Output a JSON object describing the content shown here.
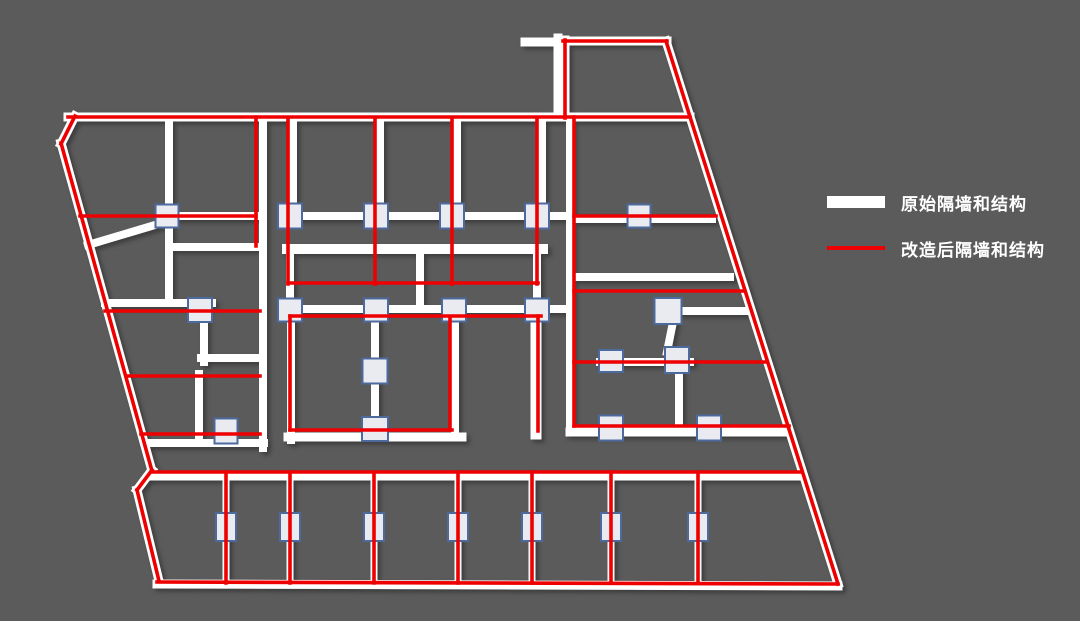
{
  "page": {
    "background_color": "#5b5b5b",
    "description": "Floor plan diagram showing original walls (thick white) overlaid with renovated partition walls and structure (red lines), with square structural columns"
  },
  "legend": {
    "items": [
      {
        "id": "original",
        "label": "原始隔墙和结构",
        "swatch_color": "#ffffff",
        "swatch_height": 12
      },
      {
        "id": "renovated",
        "label": "改造后隔墙和结构",
        "swatch_color": "#ee0000",
        "swatch_height": 4
      }
    ]
  },
  "floorplan": {
    "canvas": {
      "width": 1080,
      "height": 621
    },
    "colors": {
      "wall_white": "#ffffff",
      "wall_red": "#ee0000",
      "column_fill": "#e9ebf0",
      "column_border": "#4d6a9f"
    },
    "stroke": {
      "white_width": 8,
      "red_width": 3.6,
      "column_border_width": 2
    },
    "white_walls": [
      [
        68,
        117,
        690,
        117,
        9
      ],
      [
        75,
        116,
        61,
        144,
        9
      ],
      [
        61,
        143,
        152,
        471,
        9
      ],
      [
        152,
        470,
        137,
        490,
        9
      ],
      [
        137,
        490,
        159,
        581,
        9
      ],
      [
        157,
        584,
        838,
        586,
        9
      ],
      [
        666,
        41,
        838,
        584,
        9
      ],
      [
        563,
        41,
        667,
        41,
        9
      ],
      [
        565,
        40,
        565,
        117,
        9
      ],
      [
        525,
        42,
        560,
        42,
        9
      ],
      [
        558,
        38,
        558,
        117,
        9
      ],
      [
        169,
        117,
        169,
        303,
        8
      ],
      [
        165,
        222,
        88,
        245,
        8
      ],
      [
        170,
        247,
        263,
        247,
        8
      ],
      [
        105,
        303,
        212,
        303,
        8
      ],
      [
        204,
        308,
        204,
        362,
        8
      ],
      [
        201,
        358,
        263,
        358,
        8
      ],
      [
        199,
        374,
        199,
        443,
        8
      ],
      [
        146,
        443,
        264,
        443,
        8
      ],
      [
        263,
        117,
        263,
        448,
        8
      ],
      [
        167,
        216,
        260,
        216,
        8
      ],
      [
        295,
        216,
        568,
        216,
        8
      ],
      [
        293,
        118,
        293,
        208,
        8
      ],
      [
        380,
        118,
        380,
        208,
        8
      ],
      [
        457,
        118,
        457,
        208,
        8
      ],
      [
        542,
        118,
        542,
        208,
        8
      ],
      [
        287,
        249,
        543,
        249,
        10
      ],
      [
        420,
        249,
        420,
        305,
        8
      ],
      [
        290,
        253,
        290,
        305,
        8
      ],
      [
        537,
        253,
        537,
        305,
        8
      ],
      [
        283,
        309,
        568,
        309,
        8
      ],
      [
        375,
        313,
        375,
        434,
        8
      ],
      [
        455,
        320,
        455,
        437,
        8
      ],
      [
        291,
        320,
        291,
        440,
        8
      ],
      [
        536,
        316,
        536,
        434,
        11
      ],
      [
        288,
        437,
        462,
        437,
        9
      ],
      [
        570,
        117,
        570,
        431,
        8
      ],
      [
        573,
        219,
        712,
        219,
        8
      ],
      [
        575,
        277,
        730,
        277,
        8
      ],
      [
        668,
        311,
        747,
        311,
        8
      ],
      [
        673,
        322,
        667,
        352,
        8
      ],
      [
        600,
        362,
        690,
        362,
        8
      ],
      [
        679,
        370,
        679,
        426,
        8
      ],
      [
        570,
        432,
        786,
        432,
        9
      ],
      [
        152,
        477,
        800,
        477,
        7
      ],
      [
        226,
        474,
        226,
        582,
        7
      ],
      [
        290,
        474,
        290,
        582,
        7
      ],
      [
        374,
        474,
        374,
        582,
        7
      ],
      [
        458,
        474,
        458,
        582,
        7
      ],
      [
        532,
        474,
        532,
        582,
        7
      ],
      [
        611,
        474,
        611,
        582,
        7
      ],
      [
        698,
        474,
        698,
        582,
        7
      ]
    ],
    "red_walls": [
      [
        68,
        117,
        690,
        117
      ],
      [
        75,
        116,
        61,
        144
      ],
      [
        61,
        143,
        152,
        471
      ],
      [
        152,
        470,
        137,
        490
      ],
      [
        137,
        490,
        159,
        581
      ],
      [
        157,
        582,
        838,
        584
      ],
      [
        666,
        41,
        838,
        584
      ],
      [
        563,
        41,
        667,
        41
      ],
      [
        565,
        40,
        565,
        118
      ],
      [
        80,
        216,
        256,
        216
      ],
      [
        256,
        117,
        256,
        246
      ],
      [
        105,
        311,
        260,
        311
      ],
      [
        127,
        376,
        260,
        376
      ],
      [
        141,
        434,
        260,
        434
      ],
      [
        288,
        118,
        288,
        284
      ],
      [
        375,
        118,
        375,
        284
      ],
      [
        452,
        118,
        452,
        284
      ],
      [
        537,
        118,
        537,
        284
      ],
      [
        288,
        283,
        538,
        283
      ],
      [
        290,
        316,
        541,
        316
      ],
      [
        290,
        316,
        290,
        430
      ],
      [
        450,
        318,
        450,
        430
      ],
      [
        290,
        430,
        452,
        430
      ],
      [
        538,
        316,
        538,
        431
      ],
      [
        574,
        117,
        574,
        426
      ],
      [
        574,
        216,
        716,
        216
      ],
      [
        574,
        291,
        744,
        291
      ],
      [
        574,
        362,
        767,
        362
      ],
      [
        574,
        426,
        789,
        426
      ],
      [
        152,
        472,
        801,
        472
      ],
      [
        226,
        472,
        226,
        583
      ],
      [
        290,
        472,
        290,
        583
      ],
      [
        374,
        472,
        374,
        583
      ],
      [
        458,
        472,
        458,
        583
      ],
      [
        532,
        472,
        532,
        583
      ],
      [
        611,
        472,
        611,
        583
      ],
      [
        698,
        472,
        698,
        583
      ]
    ],
    "columns": [
      [
        167,
        216,
        23,
        23
      ],
      [
        290,
        216,
        24,
        25
      ],
      [
        376,
        216,
        24,
        25
      ],
      [
        452,
        216,
        24,
        25
      ],
      [
        537,
        216,
        24,
        25
      ],
      [
        639,
        216,
        23,
        23
      ],
      [
        200,
        310,
        24,
        24
      ],
      [
        290,
        310,
        24,
        23
      ],
      [
        376,
        310,
        24,
        23
      ],
      [
        454,
        310,
        24,
        23
      ],
      [
        537,
        310,
        24,
        23
      ],
      [
        668,
        311,
        27,
        26
      ],
      [
        375,
        371,
        25,
        25
      ],
      [
        611,
        361,
        24,
        22
      ],
      [
        677,
        360,
        24,
        26
      ],
      [
        226,
        431,
        23,
        25
      ],
      [
        375,
        429,
        26,
        24
      ],
      [
        611,
        428,
        24,
        25
      ],
      [
        709,
        428,
        24,
        25
      ],
      [
        226,
        527,
        20,
        28
      ],
      [
        290,
        527,
        20,
        28
      ],
      [
        374,
        527,
        20,
        28
      ],
      [
        458,
        527,
        20,
        28
      ],
      [
        532,
        527,
        20,
        28
      ],
      [
        611,
        527,
        20,
        28
      ],
      [
        698,
        527,
        20,
        28
      ]
    ]
  }
}
